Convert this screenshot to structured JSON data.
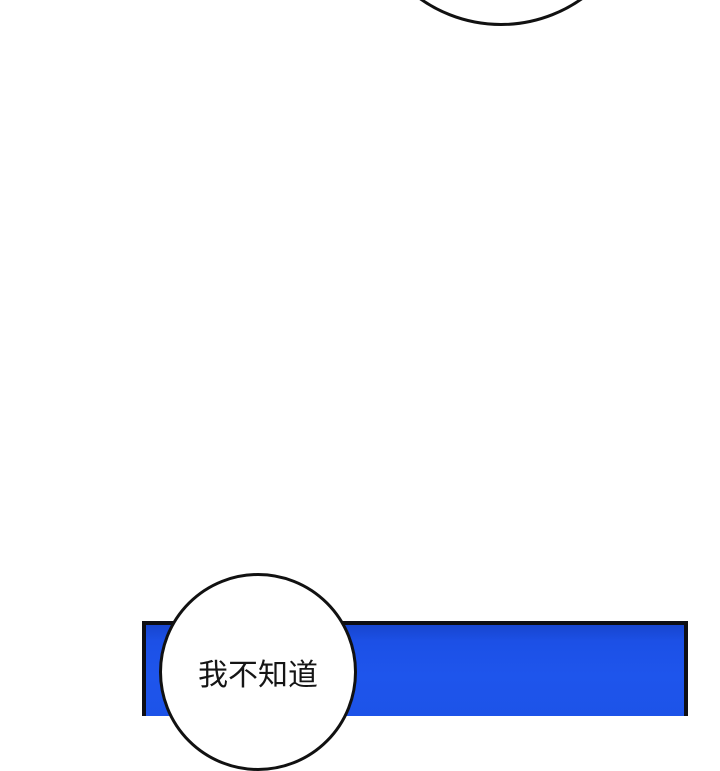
{
  "page": {
    "kind": "comic-strip-segment",
    "background_color": "#ffffff",
    "width_px": 720,
    "height_px": 700
  },
  "panel": {
    "description": "blue comic panel cropped at bottom edge",
    "fill_color": "#1e55ec",
    "fill_color_top": "#1745cf",
    "border_color": "#0e0e14"
  },
  "bubble_top": {
    "description": "partial speech bubble arc entering from top edge, no visible text",
    "fill_color": "#ffffff",
    "border_color": "#111111"
  },
  "bubble_bottom": {
    "description": "round speech bubble overlapping blue panel",
    "text": "我不知道",
    "fill_color": "#ffffff",
    "border_color": "#111111",
    "text_color": "#151515"
  }
}
